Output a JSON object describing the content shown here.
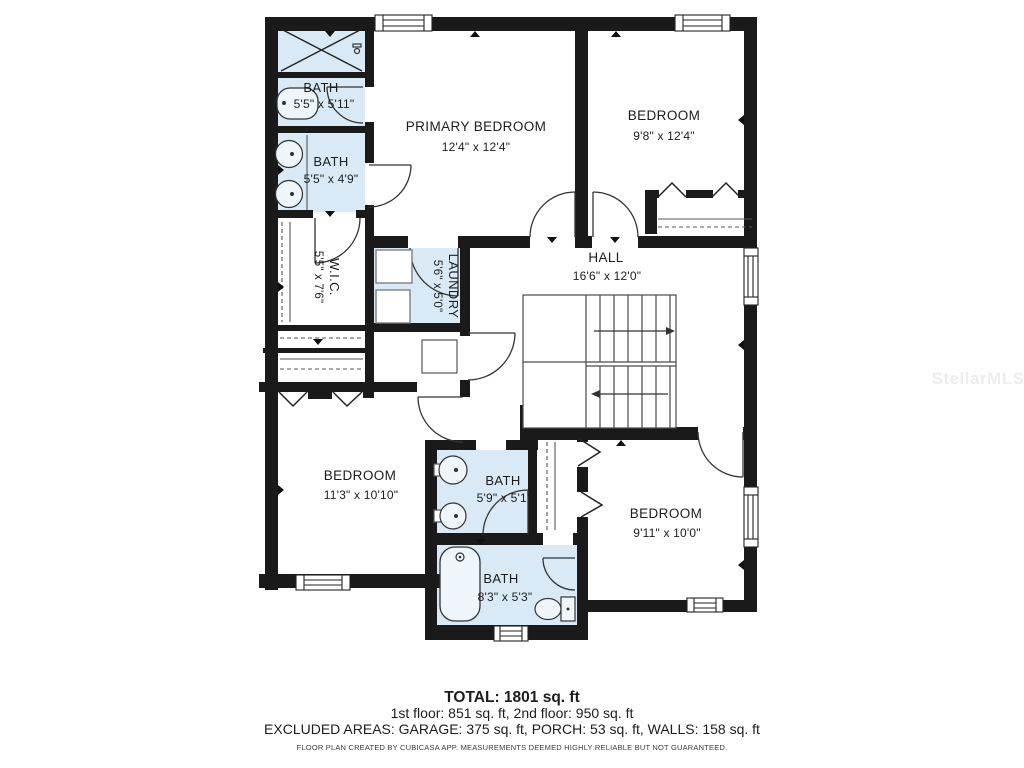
{
  "rooms": [
    {
      "id": "bath-top",
      "name": "BATH",
      "dims": "5'5\" x 5'11\""
    },
    {
      "id": "bath-vanity",
      "name": "BATH",
      "dims": "5'5\" x 4'9\""
    },
    {
      "id": "primary-bedroom",
      "name": "PRIMARY BEDROOM",
      "dims": "12'4\" x 12'4\""
    },
    {
      "id": "bedroom-top-right",
      "name": "BEDROOM",
      "dims": "9'8\" x 12'4\""
    },
    {
      "id": "wic",
      "name": "W.I.C.",
      "dims": "5'5\" x 7'6\""
    },
    {
      "id": "laundry",
      "name": "LAUNDRY",
      "dims": "5'6\" x 5'0\""
    },
    {
      "id": "hall",
      "name": "HALL",
      "dims": "16'6\" x 12'0\""
    },
    {
      "id": "bedroom-bottom-left",
      "name": "BEDROOM",
      "dims": "11'3\" x 10'10\""
    },
    {
      "id": "bath-double-sink",
      "name": "BATH",
      "dims": "5'9\" x 5'1\""
    },
    {
      "id": "bedroom-bottom-right",
      "name": "BEDROOM",
      "dims": "9'11\" x 10'0\""
    },
    {
      "id": "bath-tub",
      "name": "BATH",
      "dims": "8'3\" x 5'3\""
    }
  ],
  "summary": {
    "total": "TOTAL: 1801 sq. ft",
    "floors": "1st floor: 851 sq. ft, 2nd floor: 950 sq. ft",
    "excluded": "EXCLUDED AREAS: GARAGE: 375 sq. ft, PORCH: 53 sq. ft, WALLS: 158 sq. ft",
    "disclaimer": "FLOOR PLAN CREATED BY CUBICASA APP. MEASUREMENTS DEEMED HIGHLY RELIABLE BUT NOT GUARANTEED."
  },
  "watermark": "StellarMLS",
  "colors": {
    "wall": "#1a1a1a",
    "bath_fill": "#d9eaf6",
    "fixture_fill": "#eef6fc",
    "line": "#333333"
  }
}
